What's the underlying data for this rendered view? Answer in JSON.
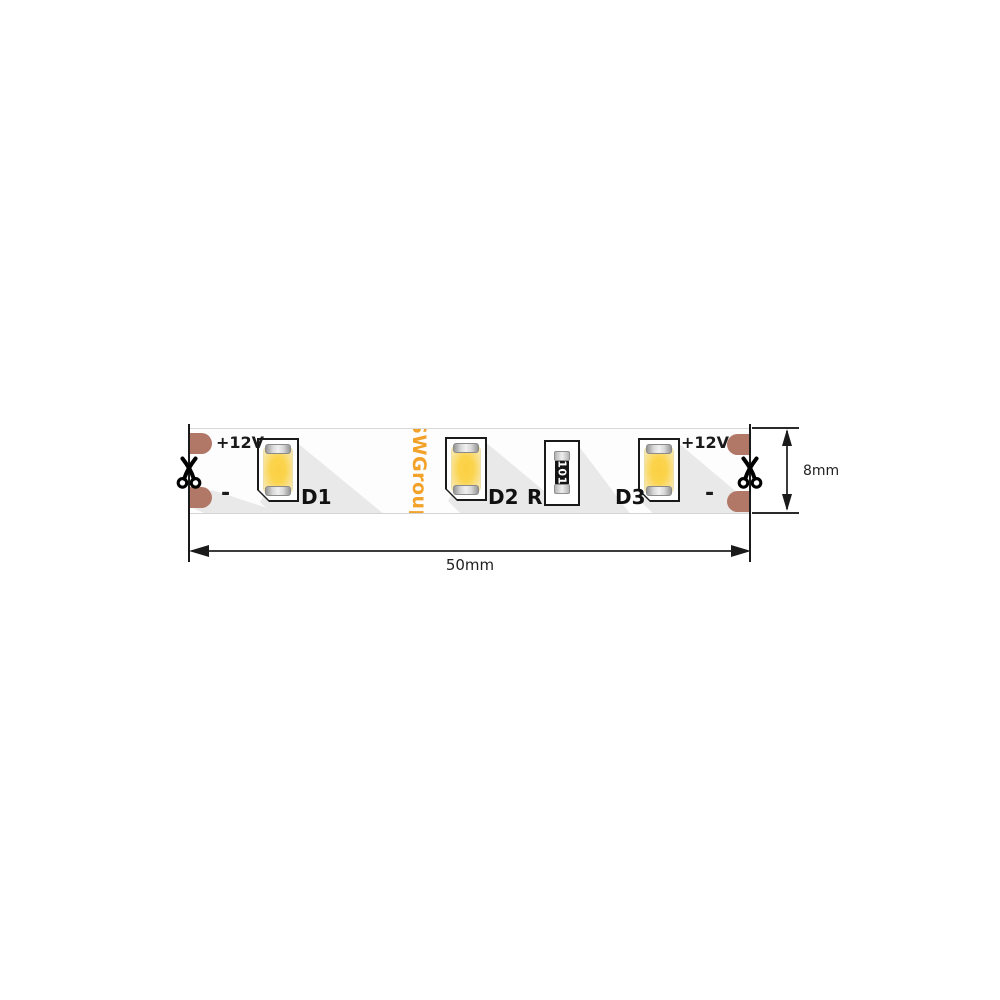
{
  "strip": {
    "brand": "SWGroup",
    "terminals": {
      "left_positive": "+12V",
      "left_negative": "-",
      "right_positive": "+12V",
      "right_negative": "-"
    },
    "components": {
      "led1_label": "D1",
      "led2_label": "D2",
      "led3_label": "D3",
      "resistor_label": "R",
      "resistor_marking": "101"
    }
  },
  "dimensions": {
    "width_label": "50mm",
    "height_label": "8mm"
  },
  "colors": {
    "copper_pad": "#b17767",
    "brand_orange": "#f2a229",
    "led_yellow": "#fbd44d",
    "outline_black": "#1a1a1a",
    "shadow_gray": "#e9e9e9"
  }
}
